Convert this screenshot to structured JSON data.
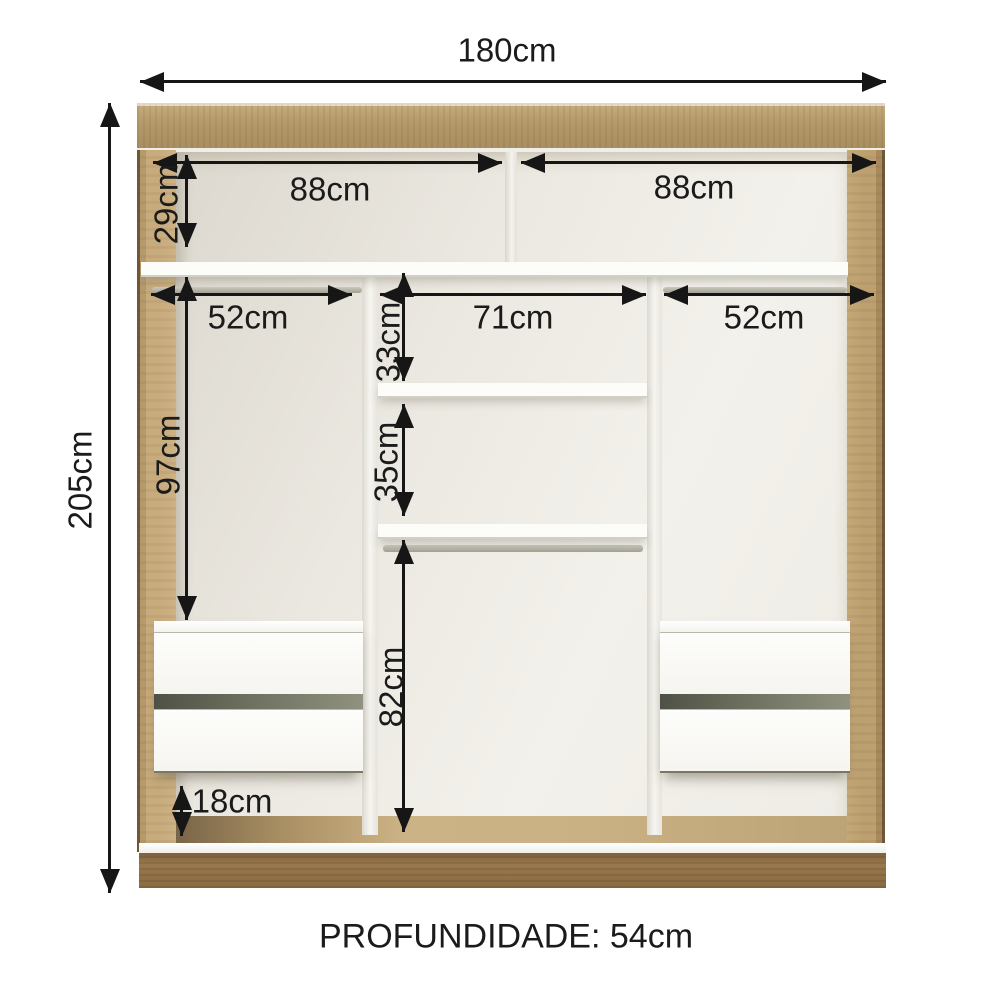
{
  "diagram": {
    "type": "furniture-dimension-diagram",
    "subject": "3-door sliding wardrobe internal layout, front view"
  },
  "dimensions": {
    "total_width": "180cm",
    "total_height": "205cm",
    "top_left_width": "88cm",
    "top_right_width": "88cm",
    "top_height": "29cm",
    "left_width": "52cm",
    "center_width": "71cm",
    "right_width": "52cm",
    "left_height": "97cm",
    "center_upper_height": "33cm",
    "center_middle_height": "35cm",
    "center_lower_height": "82cm",
    "bottom_clearance": "18cm"
  },
  "footer": {
    "depth_label": "PROFUNDIDADE: 54cm"
  },
  "colors": {
    "arrow": "#161616",
    "text": "#1b1b1b",
    "frame_wood": "#b39969",
    "frame_wood_light": "#c9ad7e",
    "frame_wood_dark": "#8a6d46",
    "plinth_wood": "#98784c",
    "interior_light": "#f3f1eb",
    "interior_shade": "#ddd9d0",
    "shelf_white": "#fcfcf9",
    "divider_white": "#f2f1ec",
    "rod_gray": "#b5b3a8",
    "drawer_white": "#fbfbf9",
    "drawer_gap": "#5e6152",
    "floor_tan": "#c9b184"
  }
}
